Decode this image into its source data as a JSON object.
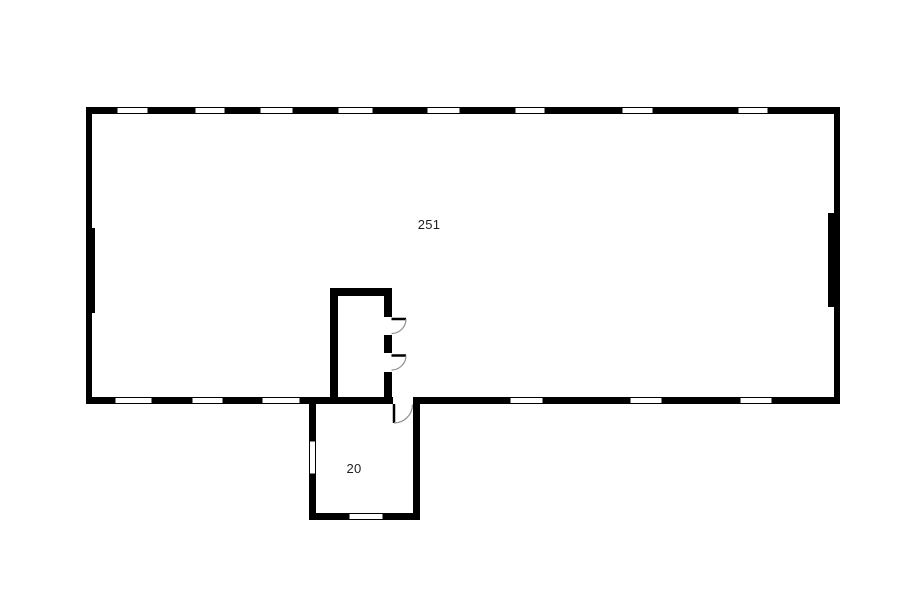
{
  "plan": {
    "background": "#ffffff",
    "wall_color": "#000000",
    "window_fill": "#ffffff",
    "door_arc_color": "#8f8f8f",
    "label_color": "#1f1f1f",
    "rooms": [
      {
        "id": "main-room",
        "label": "251"
      },
      {
        "id": "small-room",
        "label": "20"
      }
    ]
  }
}
